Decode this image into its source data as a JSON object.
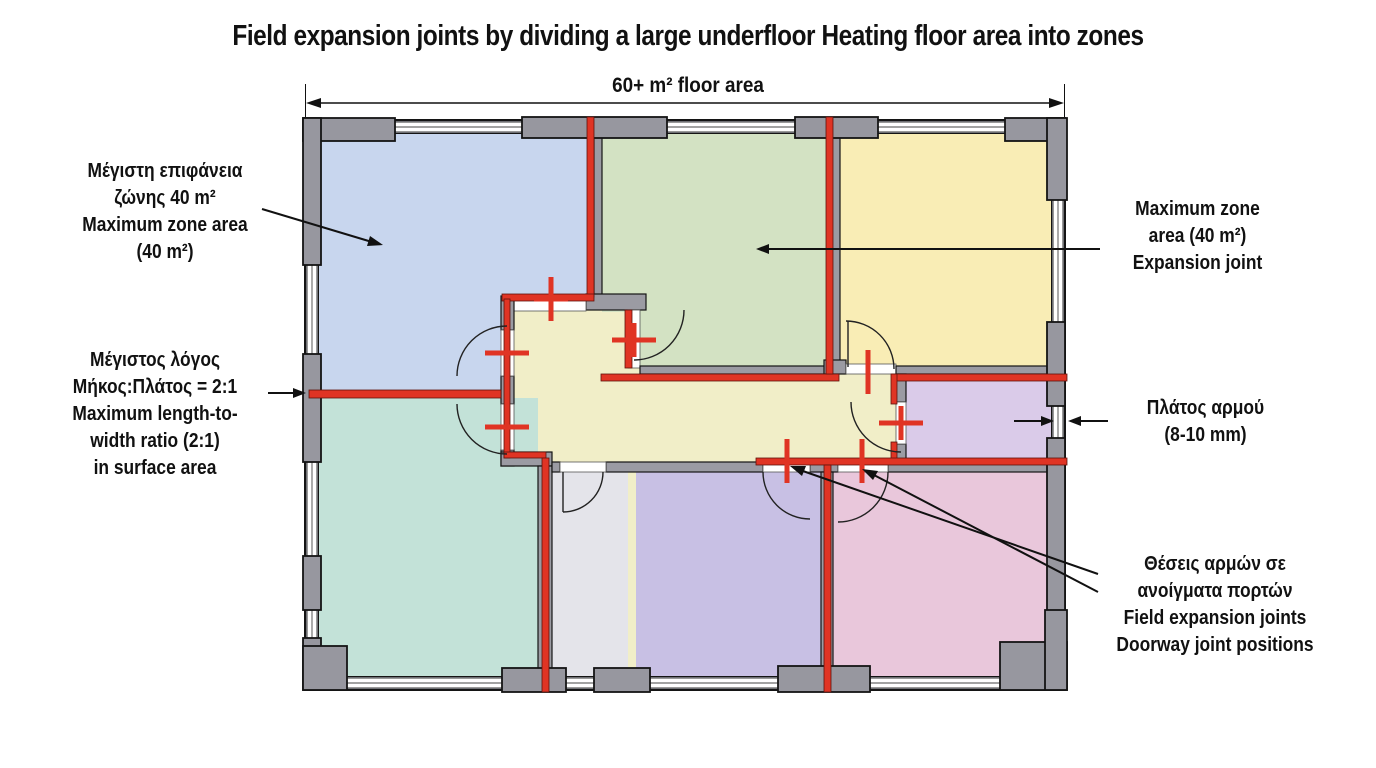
{
  "title": "Field expansion joints by dividing a large underfloor Heating floor area into zones",
  "dimension": {
    "label": "60+ m² floor area"
  },
  "annotations": {
    "max_zone_left": {
      "lines": [
        "Μέγιστη επιφάνεια",
        "ζώνης 40 m²",
        "Maximum zone area",
        "(40 m²)"
      ]
    },
    "ratio": {
      "lines": [
        "Μέγιστος λόγος",
        "Μήκος:Πλάτος = 2:1",
        "Maximum length-to-",
        "width ratio (2:1)",
        "in surface area"
      ]
    },
    "max_zone_right": {
      "lines": [
        "Maximum zone",
        "area (40 m²)",
        "Expansion joint"
      ]
    },
    "joint_width": {
      "lines": [
        "Πλάτος αρμού",
        "(8-10 mm)"
      ]
    },
    "doorway_joints": {
      "lines": [
        "Θέσεις αρμών σε",
        "ανοίγματα πορτών",
        "Field expansion joints",
        "Doorway joint positions"
      ]
    }
  },
  "colors": {
    "joint": "#e03424",
    "wall": "#abacb4",
    "pier": "#97979f",
    "outline": "#141414"
  },
  "floor_plan": {
    "zones": [
      {
        "id": "zone-top-left",
        "color": "#c8d6ee"
      },
      {
        "id": "zone-top-middle",
        "color": "#d3e2c3"
      },
      {
        "id": "zone-top-right",
        "color": "#f9edb5"
      },
      {
        "id": "zone-bottom-left",
        "color": "#c3e2d8"
      },
      {
        "id": "zone-bottom-small",
        "color": "#e4e4ea"
      },
      {
        "id": "zone-bottom-middle",
        "color": "#c8c0e4"
      },
      {
        "id": "zone-bottom-right",
        "color": "#e9c7db"
      },
      {
        "id": "zone-right-small",
        "color": "#dacbe9"
      },
      {
        "id": "hallway",
        "color": "#f1eec8"
      }
    ]
  }
}
